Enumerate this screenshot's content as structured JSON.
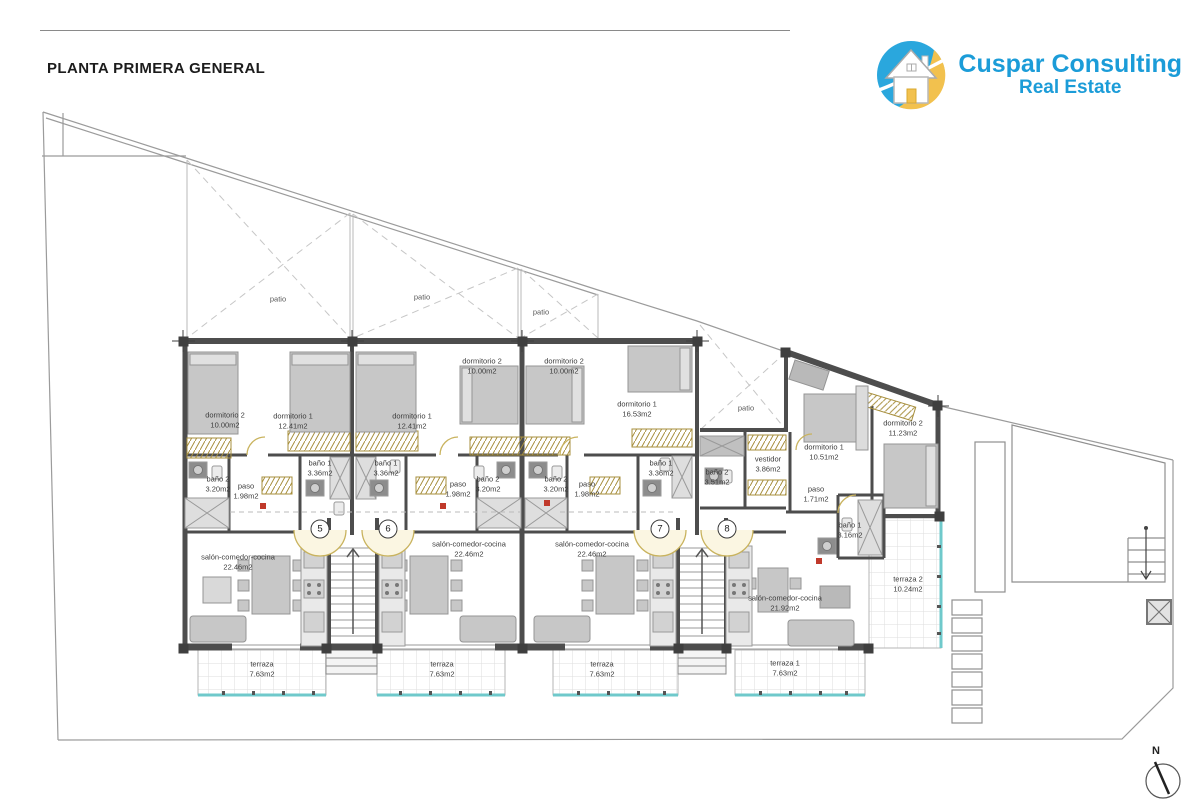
{
  "title": "PLANTA PRIMERA GENERAL",
  "logo": {
    "company": "Cuspar Consulting",
    "tagline": "Real Estate"
  },
  "compass": {
    "label": "N"
  },
  "colors": {
    "wall": "#4d4d4d",
    "terrace_glass": "#6fc9cb",
    "door_arc": "#c9b35e",
    "wardrobe_hatch": "#a78f3d",
    "brand_blue": "#1b9cd8",
    "brand_yellow": "#f2c14e",
    "label_text": "#3c3c3c"
  },
  "plan": {
    "unit_markers": [
      {
        "number": "5",
        "x": 320,
        "y": 529
      },
      {
        "number": "6",
        "x": 388,
        "y": 529
      },
      {
        "number": "7",
        "x": 660,
        "y": 529
      },
      {
        "number": "8",
        "x": 727,
        "y": 529
      }
    ],
    "patio_labels": [
      {
        "name": "patio",
        "x": 278,
        "y": 299
      },
      {
        "name": "patio",
        "x": 422,
        "y": 297
      },
      {
        "name": "patio",
        "x": 541,
        "y": 312
      },
      {
        "name": "patio",
        "x": 746,
        "y": 408
      }
    ],
    "room_labels": [
      {
        "unit": "5",
        "name": "dormitorio 2",
        "area": "10.00m2",
        "x": 225,
        "y": 420
      },
      {
        "unit": "5",
        "name": "dormitorio 1",
        "area": "12.41m2",
        "x": 293,
        "y": 421
      },
      {
        "unit": "5",
        "name": "baño 2",
        "area": "3.20m2",
        "x": 218,
        "y": 484
      },
      {
        "unit": "5",
        "name": "paso",
        "area": "1.98m2",
        "x": 246,
        "y": 491
      },
      {
        "unit": "5",
        "name": "baño 1",
        "area": "3.36m2",
        "x": 320,
        "y": 468
      },
      {
        "unit": "5",
        "name": "salón-comedor-cocina",
        "area": "22.46m2",
        "x": 238,
        "y": 562
      },
      {
        "unit": "5",
        "name": "terraza",
        "area": "7.63m2",
        "x": 262,
        "y": 669
      },
      {
        "unit": "6",
        "name": "dormitorio 1",
        "area": "12.41m2",
        "x": 412,
        "y": 421
      },
      {
        "unit": "6",
        "name": "dormitorio 2",
        "area": "10.00m2",
        "x": 482,
        "y": 366
      },
      {
        "unit": "6",
        "name": "baño 1",
        "area": "3.36m2",
        "x": 386,
        "y": 468
      },
      {
        "unit": "6",
        "name": "baño 2",
        "area": "3.20m2",
        "x": 488,
        "y": 484
      },
      {
        "unit": "6",
        "name": "paso",
        "area": "1.98m2",
        "x": 458,
        "y": 489
      },
      {
        "unit": "6",
        "name": "salón-comedor-cocina",
        "area": "22.46m2",
        "x": 469,
        "y": 549
      },
      {
        "unit": "6",
        "name": "terraza",
        "area": "7.63m2",
        "x": 442,
        "y": 669
      },
      {
        "unit": "7",
        "name": "dormitorio 2",
        "area": "10.00m2",
        "x": 564,
        "y": 366
      },
      {
        "unit": "7",
        "name": "dormitorio 1",
        "area": "16.53m2",
        "x": 637,
        "y": 409
      },
      {
        "unit": "7",
        "name": "baño 2",
        "area": "3.20m2",
        "x": 556,
        "y": 484
      },
      {
        "unit": "7",
        "name": "paso",
        "area": "1.98m2",
        "x": 587,
        "y": 489
      },
      {
        "unit": "7",
        "name": "baño 1",
        "area": "3.36m2",
        "x": 661,
        "y": 468
      },
      {
        "unit": "7",
        "name": "salón-comedor-cocina",
        "area": "22.46m2",
        "x": 592,
        "y": 549
      },
      {
        "unit": "7",
        "name": "terraza",
        "area": "7.63m2",
        "x": 602,
        "y": 669
      },
      {
        "unit": "8",
        "name": "dormitorio 1",
        "area": "10.51m2",
        "x": 824,
        "y": 452
      },
      {
        "unit": "8",
        "name": "dormitorio 2",
        "area": "11.23m2",
        "x": 903,
        "y": 428
      },
      {
        "unit": "8",
        "name": "baño 2",
        "area": "3.51m2",
        "x": 717,
        "y": 477
      },
      {
        "unit": "8",
        "name": "vestidor",
        "area": "3.86m2",
        "x": 768,
        "y": 464
      },
      {
        "unit": "8",
        "name": "paso",
        "area": "1.71m2",
        "x": 816,
        "y": 494
      },
      {
        "unit": "8",
        "name": "baño 1",
        "area": "3.16m2",
        "x": 850,
        "y": 530
      },
      {
        "unit": "8",
        "name": "salón-comedor-cocina",
        "area": "21.92m2",
        "x": 785,
        "y": 603
      },
      {
        "unit": "8",
        "name": "terraza 2",
        "area": "10.24m2",
        "x": 908,
        "y": 584
      },
      {
        "unit": "8",
        "name": "terraza 1",
        "area": "7.63m2",
        "x": 785,
        "y": 668
      }
    ]
  }
}
